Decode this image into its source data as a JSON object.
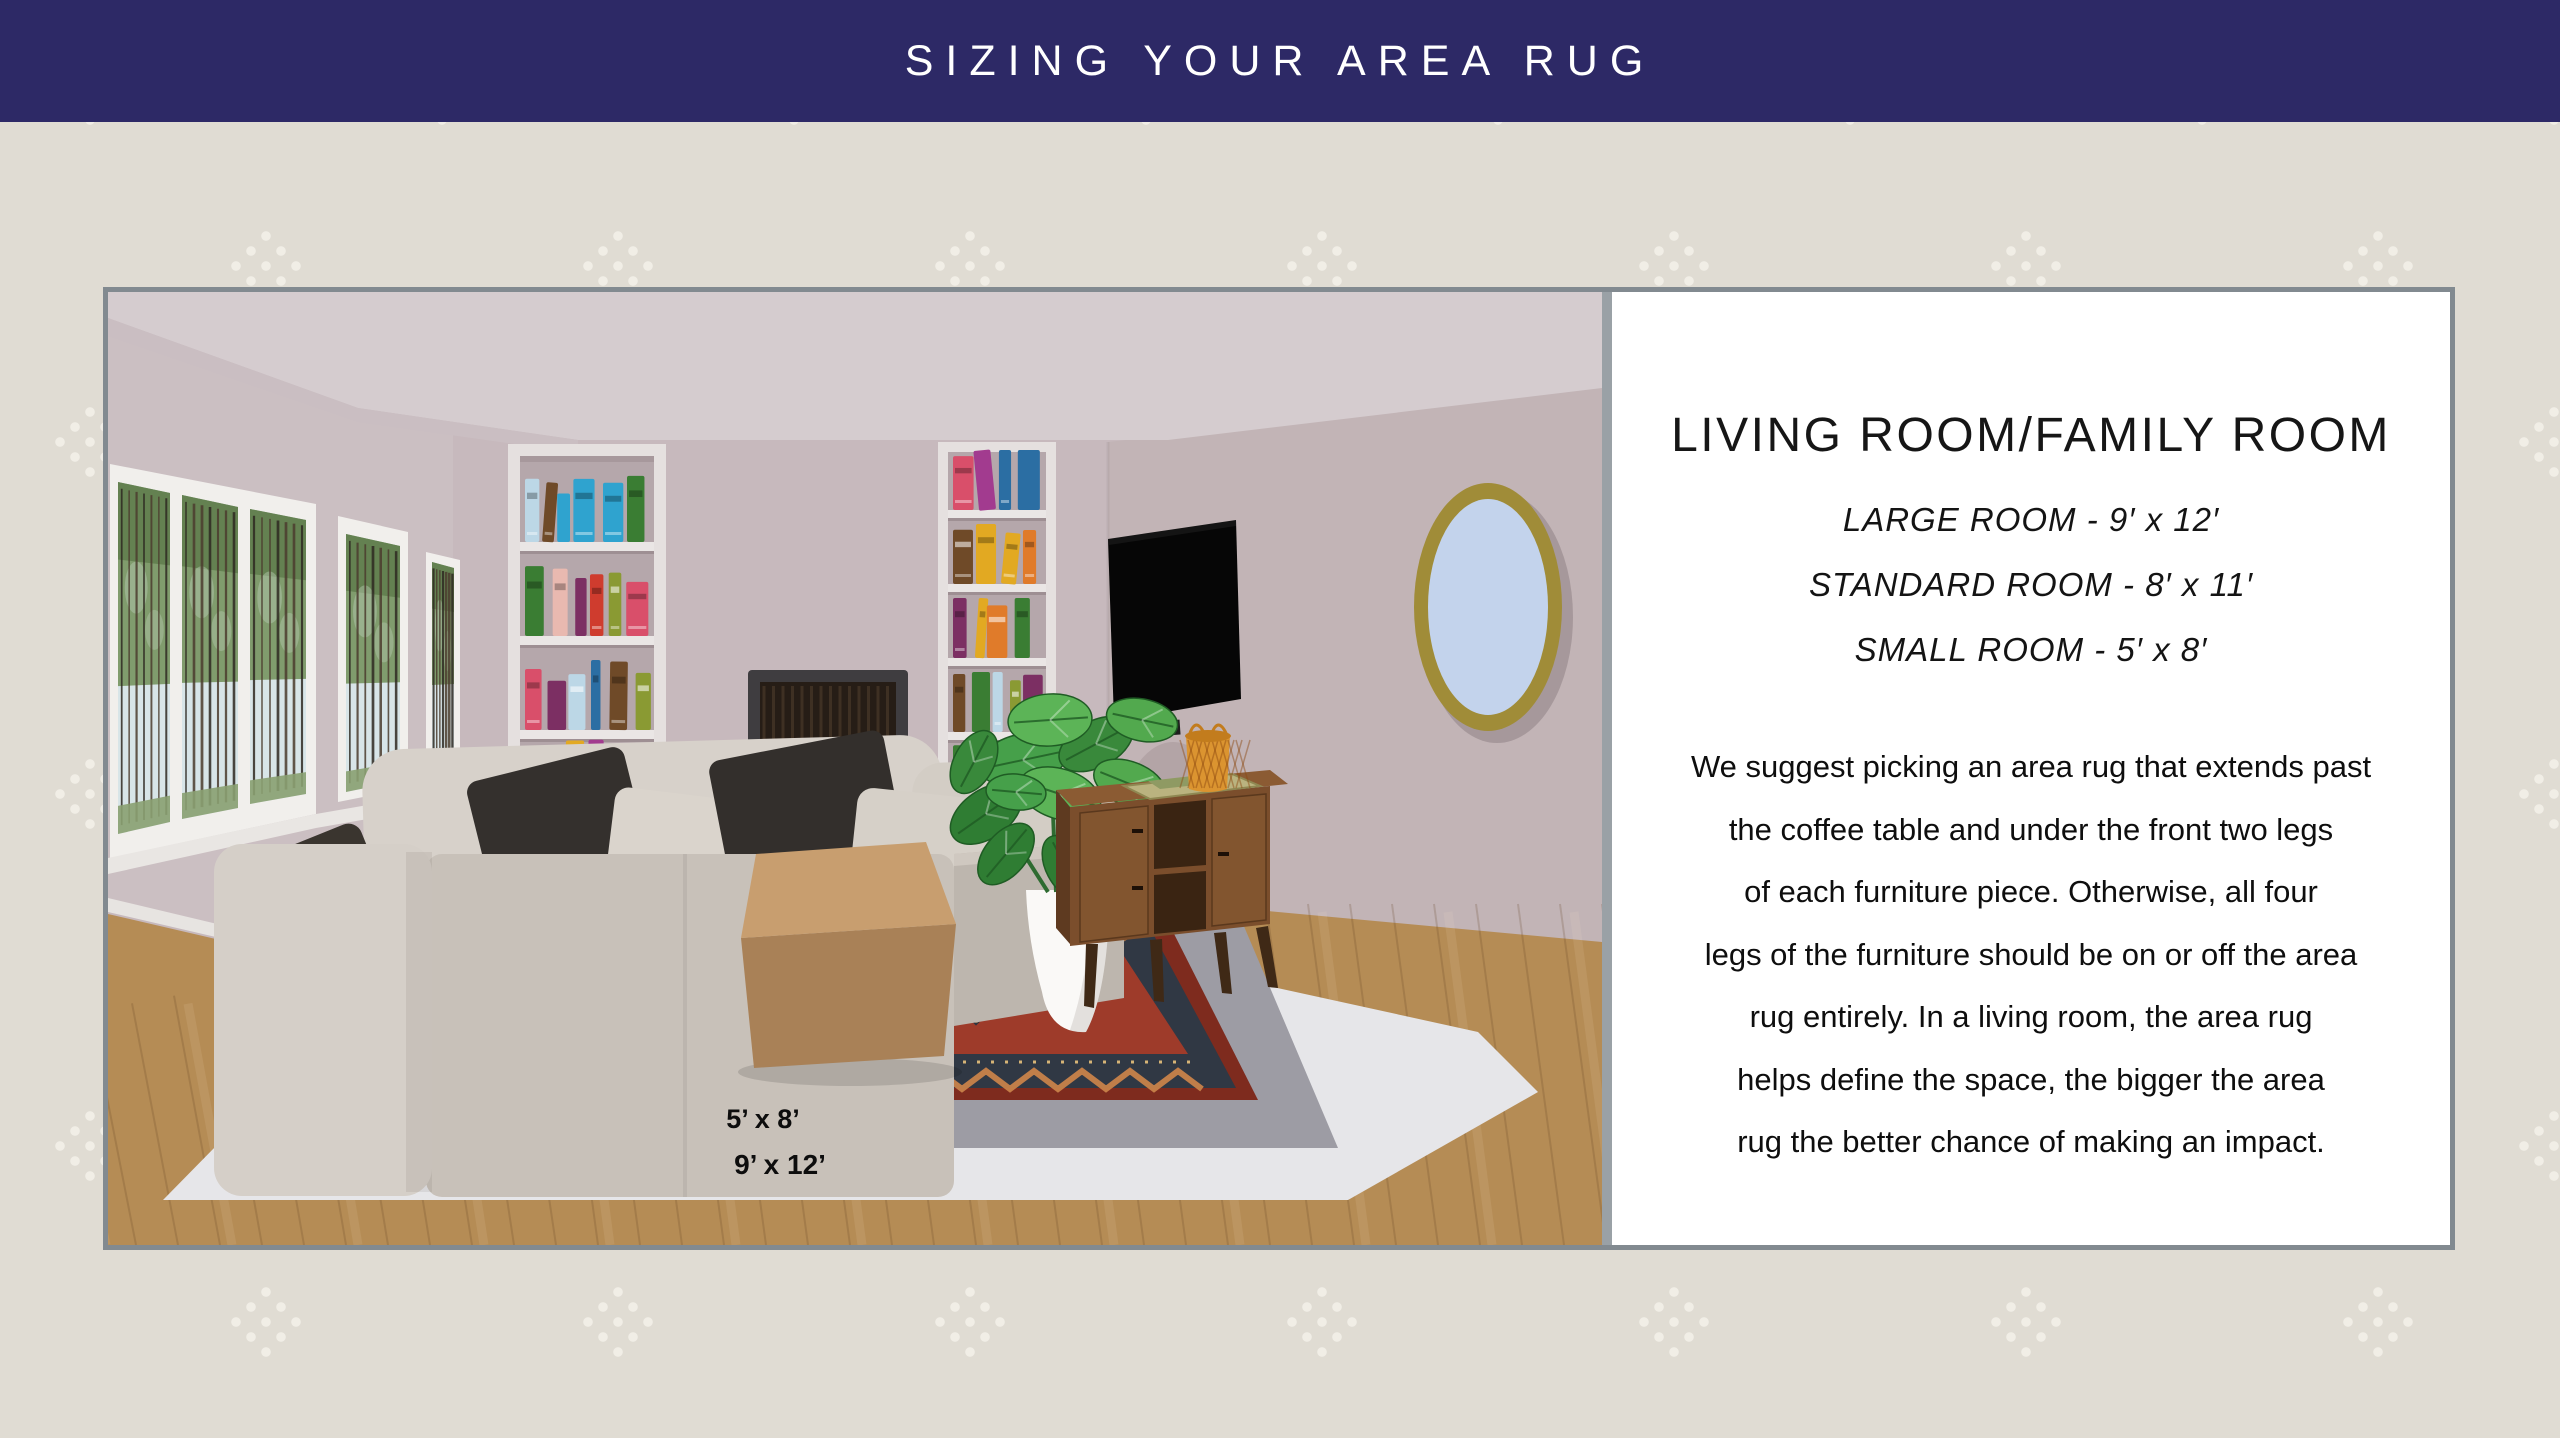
{
  "banner": {
    "title": "SIZING YOUR AREA RUG",
    "bg_color": "#2d2966",
    "text_color": "#ffffff"
  },
  "background": {
    "color": "#e0dcd3",
    "dot_color": "#f1eee6"
  },
  "card": {
    "border_color": "#828a90",
    "divider_color": "#9aa1a6"
  },
  "panel": {
    "heading": "LIVING ROOM/FAMILY ROOM",
    "sizes": [
      {
        "label": "LARGE ROOM - 9′ x 12′"
      },
      {
        "label": "STANDARD ROOM - 8′ x 11′"
      },
      {
        "label": "SMALL ROOM - 5′ x 8′"
      }
    ],
    "paragraph_lines": [
      "We suggest picking an area rug that extends past",
      "the coffee table and under the front two legs",
      "of each furniture piece. Otherwise, all four",
      "legs of the furniture should be on or off the area",
      "rug entirely. In a living room, the area rug",
      "helps define the space, the bigger the area",
      "rug the better chance of making an impact."
    ]
  },
  "illustration": {
    "rug_labels": [
      {
        "text": "5’ x 8’"
      },
      {
        "text": "9’ x 12’"
      }
    ],
    "colors": {
      "wall": "#c7b9bd",
      "wall_right": "#c2b4b6",
      "wall_left": "#cbbfc2",
      "ceiling": "#d5cccf",
      "floor_wood": "#b58c55",
      "rug_light": "#e6e6e9",
      "rug_gray": "#9d9ca4",
      "rug_red": "#9e3b2a",
      "rug_border": "#303844",
      "rug_accent": "#c8824a",
      "brick": "#8e4a3c",
      "mortar": "#d8cec6",
      "sofa": "#d5cfc8",
      "pillow_dark": "#34302d",
      "table": "#c89e6f",
      "console": "#7b4e2c",
      "mirror_frame": "#a08c38",
      "mirror_glass": "#c3d3ec",
      "basket": "#db9430",
      "plant": "#3a8d3c",
      "fire": "#ff8c1e",
      "shelf": "#e5e0df",
      "shelf_back": "#b5a7ab"
    },
    "book_palette": [
      "#e9b9b0",
      "#f5f1e8",
      "#3a7d33",
      "#e2a922",
      "#2fa3cf",
      "#cf3c2e",
      "#7c2f63",
      "#8a9a33",
      "#6f4a28",
      "#bcd7e6",
      "#e07b2a",
      "#a23b8f",
      "#2b6ea3",
      "#d94f6a"
    ]
  }
}
